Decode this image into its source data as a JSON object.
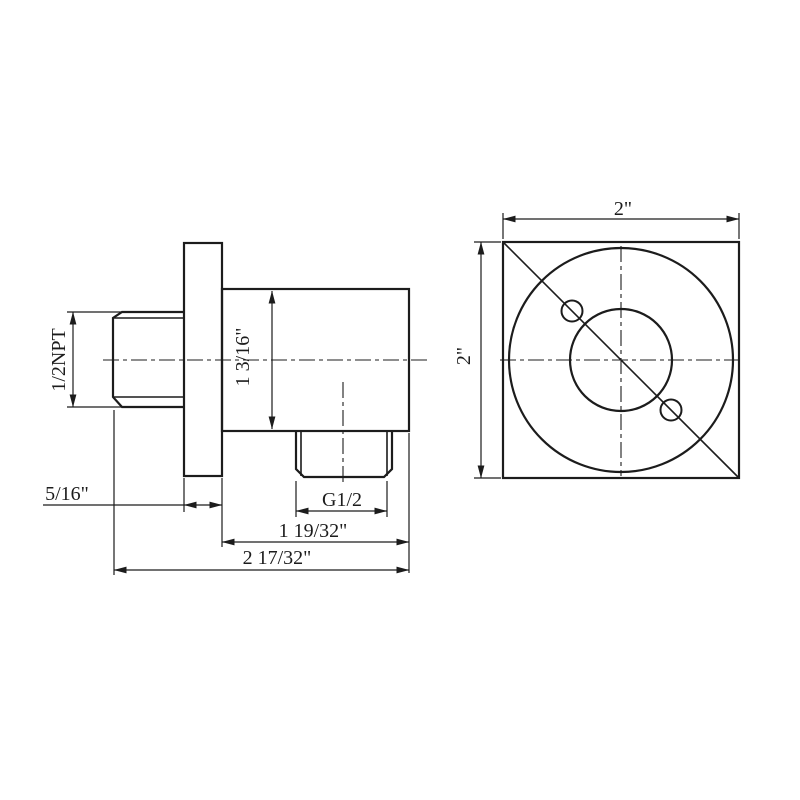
{
  "drawing_type": "technical-dimension-drawing",
  "colors": {
    "line": "#1c1c1c",
    "background": "#ffffff"
  },
  "side_view": {
    "inlet_thread_label": "1/2NPT",
    "flange_thickness_label": "5/16\"",
    "body_height_label": "1 3/16\"",
    "outlet_thread_label": "G1/2",
    "body_width_label": "1 19/32\"",
    "overall_width_label": "2 17/32\""
  },
  "front_view": {
    "width_label": "2\"",
    "height_label": "2\""
  }
}
